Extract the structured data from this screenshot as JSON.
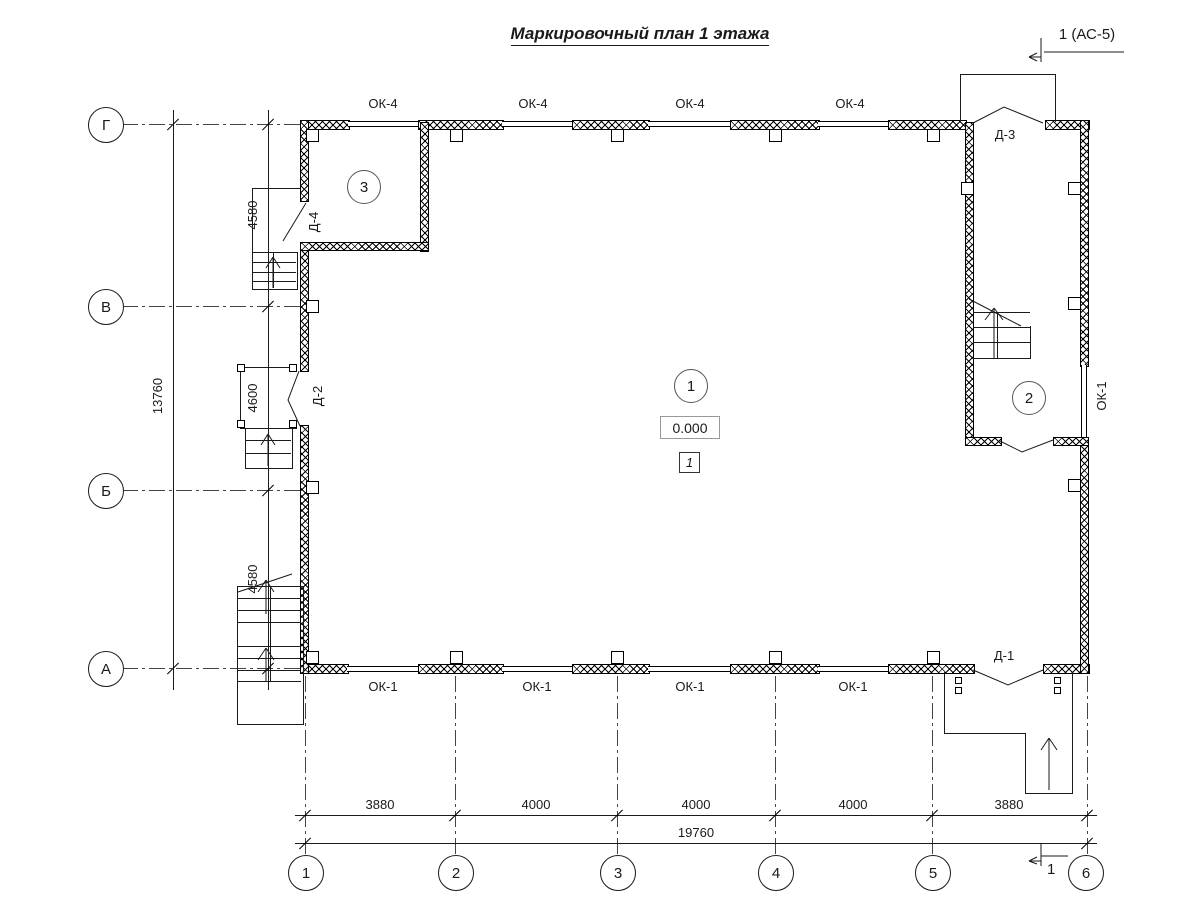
{
  "title": "Маркировочный план 1 этажа",
  "section_marks": {
    "top": "1 (АС-5)",
    "bottom": "1"
  },
  "row_axes": [
    "Г",
    "В",
    "Б",
    "А"
  ],
  "col_axes": [
    "1",
    "2",
    "3",
    "4",
    "5",
    "6"
  ],
  "dims": {
    "left": {
      "segments": [
        "4580",
        "4600",
        "4580"
      ],
      "total": "13760"
    },
    "bottom": {
      "segments": [
        "3880",
        "4000",
        "4000",
        "4000",
        "3880"
      ],
      "total": "19760"
    }
  },
  "windows": {
    "top": [
      "ОК-4",
      "ОК-4",
      "ОК-4",
      "ОК-4"
    ],
    "bottom": [
      "ОК-1",
      "ОК-1",
      "ОК-1",
      "ОК-1"
    ],
    "right": "ОК-1"
  },
  "doors": {
    "d1": "Д-1",
    "d2": "Д-2",
    "d3": "Д-3",
    "d4": "Д-4"
  },
  "rooms": {
    "hall": "1",
    "room2": "2",
    "room3": "3"
  },
  "elevation": "0.000",
  "zone_mark": "1",
  "colors": {
    "line": "#1a1a1a",
    "background": "#ffffff"
  }
}
